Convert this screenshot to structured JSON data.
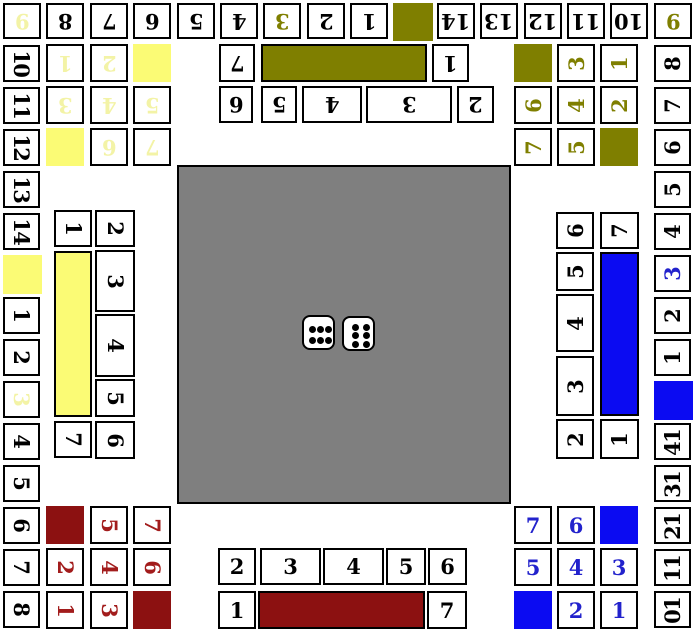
{
  "board": {
    "width": 694,
    "height": 630,
    "background": "#ffffff"
  },
  "palette": {
    "border": "#000000",
    "cell_bg": "#ffffff",
    "black": "#000000",
    "gray_center": "#7f7f7f",
    "olive": "#7f7f00",
    "yellow_fill": "#fbfb75",
    "yellow_text": "#f3f3a6",
    "blue_fill": "#0b0bf2",
    "blue_text": "#2222cc",
    "red_fill": "#8c1111",
    "red_text": "#a21c1c"
  },
  "center": {
    "x": 177,
    "y": 165,
    "w": 334,
    "h": 339
  },
  "dice": {
    "values": [
      6,
      6
    ],
    "items": [
      {
        "name": "die-left",
        "x": 302,
        "y": 315,
        "w": 33,
        "h": 35,
        "pips": "6h"
      },
      {
        "name": "die-right",
        "x": 342,
        "y": 316,
        "w": 33,
        "h": 35,
        "pips": "6v"
      }
    ]
  },
  "regions": [
    {
      "name": "track-top",
      "rot": 180,
      "text": "black",
      "fill": "olive",
      "cells": [
        {
          "l": "9",
          "x": 3,
          "y": 3,
          "w": 38,
          "h": 36,
          "tc": "yellow_text"
        },
        {
          "l": "8",
          "x": 46,
          "y": 3,
          "w": 38,
          "h": 36
        },
        {
          "l": "7",
          "x": 90,
          "y": 3,
          "w": 38,
          "h": 36
        },
        {
          "l": "6",
          "x": 133,
          "y": 3,
          "w": 38,
          "h": 36
        },
        {
          "l": "5",
          "x": 177,
          "y": 3,
          "w": 38,
          "h": 36
        },
        {
          "l": "4",
          "x": 220,
          "y": 3,
          "w": 38,
          "h": 36
        },
        {
          "l": "3",
          "x": 263,
          "y": 3,
          "w": 38,
          "h": 36,
          "tc": "olive"
        },
        {
          "l": "2",
          "x": 307,
          "y": 3,
          "w": 38,
          "h": 36
        },
        {
          "l": "1",
          "x": 350,
          "y": 3,
          "w": 38,
          "h": 36
        },
        {
          "l": null,
          "x": 393,
          "y": 3,
          "w": 40,
          "h": 38
        },
        {
          "l": "14",
          "x": 437,
          "y": 3,
          "w": 38,
          "h": 36
        },
        {
          "l": "13",
          "x": 480,
          "y": 3,
          "w": 38,
          "h": 36
        },
        {
          "l": "12",
          "x": 524,
          "y": 3,
          "w": 38,
          "h": 36
        },
        {
          "l": "11",
          "x": 567,
          "y": 3,
          "w": 38,
          "h": 36
        },
        {
          "l": "10",
          "x": 610,
          "y": 3,
          "w": 38,
          "h": 36
        },
        {
          "l": "9",
          "x": 654,
          "y": 3,
          "w": 38,
          "h": 36,
          "tc": "olive"
        }
      ]
    },
    {
      "name": "track-left",
      "rot": 90,
      "text": "black",
      "fill": "yellow_fill",
      "cells": [
        {
          "l": "10",
          "x": 3,
          "y": 45,
          "w": 37,
          "h": 37
        },
        {
          "l": "11",
          "x": 3,
          "y": 87,
          "w": 37,
          "h": 37
        },
        {
          "l": "12",
          "x": 3,
          "y": 129,
          "w": 37,
          "h": 37
        },
        {
          "l": "13",
          "x": 3,
          "y": 171,
          "w": 37,
          "h": 37
        },
        {
          "l": "14",
          "x": 3,
          "y": 213,
          "w": 37,
          "h": 37
        },
        {
          "l": null,
          "x": 3,
          "y": 255,
          "w": 39,
          "h": 39
        },
        {
          "l": "1",
          "x": 3,
          "y": 297,
          "w": 37,
          "h": 37
        },
        {
          "l": "2",
          "x": 3,
          "y": 339,
          "w": 37,
          "h": 37
        },
        {
          "l": "3",
          "x": 3,
          "y": 381,
          "w": 37,
          "h": 37,
          "tc": "yellow_text"
        },
        {
          "l": "4",
          "x": 3,
          "y": 423,
          "w": 37,
          "h": 37
        },
        {
          "l": "5",
          "x": 3,
          "y": 465,
          "w": 37,
          "h": 37
        },
        {
          "l": "6",
          "x": 3,
          "y": 507,
          "w": 37,
          "h": 37
        },
        {
          "l": "7",
          "x": 3,
          "y": 549,
          "w": 37,
          "h": 37
        },
        {
          "l": "8",
          "x": 3,
          "y": 591,
          "w": 37,
          "h": 37
        }
      ]
    },
    {
      "name": "track-right",
      "rot": -90,
      "text": "black",
      "fill": "blue_fill",
      "cells": [
        {
          "l": "8",
          "x": 654,
          "y": 45,
          "w": 37,
          "h": 37
        },
        {
          "l": "7",
          "x": 654,
          "y": 87,
          "w": 37,
          "h": 37
        },
        {
          "l": "6",
          "x": 654,
          "y": 129,
          "w": 37,
          "h": 37
        },
        {
          "l": "5",
          "x": 654,
          "y": 171,
          "w": 37,
          "h": 37
        },
        {
          "l": "4",
          "x": 654,
          "y": 213,
          "w": 37,
          "h": 37
        },
        {
          "l": "3",
          "x": 654,
          "y": 255,
          "w": 37,
          "h": 37,
          "tc": "blue_text"
        },
        {
          "l": "2",
          "x": 654,
          "y": 297,
          "w": 37,
          "h": 37
        },
        {
          "l": "1",
          "x": 654,
          "y": 339,
          "w": 37,
          "h": 37
        },
        {
          "l": null,
          "x": 654,
          "y": 381,
          "w": 39,
          "h": 39
        },
        {
          "l": "14",
          "x": 654,
          "y": 423,
          "w": 37,
          "h": 37
        },
        {
          "l": "13",
          "x": 654,
          "y": 465,
          "w": 37,
          "h": 37
        },
        {
          "l": "12",
          "x": 654,
          "y": 507,
          "w": 37,
          "h": 37
        },
        {
          "l": "11",
          "x": 654,
          "y": 549,
          "w": 37,
          "h": 37
        },
        {
          "l": "10",
          "x": 654,
          "y": 591,
          "w": 37,
          "h": 37
        }
      ]
    },
    {
      "name": "stable-yellow",
      "rot": 180,
      "text": "yellow_text",
      "fill": "yellow_fill",
      "cells": [
        {
          "l": "1",
          "x": 46,
          "y": 44,
          "w": 38,
          "h": 38
        },
        {
          "l": "2",
          "x": 90,
          "y": 44,
          "w": 38,
          "h": 38
        },
        {
          "l": null,
          "x": 133,
          "y": 44,
          "w": 38,
          "h": 38
        },
        {
          "l": "3",
          "x": 46,
          "y": 86,
          "w": 38,
          "h": 38
        },
        {
          "l": "4",
          "x": 90,
          "y": 86,
          "w": 38,
          "h": 38
        },
        {
          "l": "5",
          "x": 133,
          "y": 86,
          "w": 38,
          "h": 38
        },
        {
          "l": null,
          "x": 46,
          "y": 128,
          "w": 38,
          "h": 38
        },
        {
          "l": "6",
          "x": 90,
          "y": 128,
          "w": 38,
          "h": 38
        },
        {
          "l": "7",
          "x": 133,
          "y": 128,
          "w": 38,
          "h": 38
        }
      ]
    },
    {
      "name": "stable-olive",
      "rot": -90,
      "text": "olive",
      "fill": "olive",
      "cells": [
        {
          "l": null,
          "x": 514,
          "y": 44,
          "w": 38,
          "h": 38
        },
        {
          "l": "3",
          "x": 557,
          "y": 44,
          "w": 38,
          "h": 38
        },
        {
          "l": "1",
          "x": 600,
          "y": 44,
          "w": 38,
          "h": 38
        },
        {
          "l": "6",
          "x": 514,
          "y": 86,
          "w": 38,
          "h": 38
        },
        {
          "l": "4",
          "x": 557,
          "y": 86,
          "w": 38,
          "h": 38
        },
        {
          "l": "2",
          "x": 600,
          "y": 86,
          "w": 38,
          "h": 38
        },
        {
          "l": "7",
          "x": 514,
          "y": 128,
          "w": 38,
          "h": 38
        },
        {
          "l": "5",
          "x": 557,
          "y": 128,
          "w": 38,
          "h": 38
        },
        {
          "l": null,
          "x": 600,
          "y": 128,
          "w": 38,
          "h": 38
        }
      ]
    },
    {
      "name": "stable-blue",
      "rot": 0,
      "text": "blue_text",
      "fill": "blue_fill",
      "cells": [
        {
          "l": "7",
          "x": 514,
          "y": 506,
          "w": 38,
          "h": 38
        },
        {
          "l": "6",
          "x": 557,
          "y": 506,
          "w": 38,
          "h": 38
        },
        {
          "l": null,
          "x": 600,
          "y": 506,
          "w": 38,
          "h": 38
        },
        {
          "l": "5",
          "x": 514,
          "y": 548,
          "w": 38,
          "h": 38
        },
        {
          "l": "4",
          "x": 557,
          "y": 548,
          "w": 38,
          "h": 38
        },
        {
          "l": "3",
          "x": 600,
          "y": 548,
          "w": 38,
          "h": 38
        },
        {
          "l": null,
          "x": 514,
          "y": 591,
          "w": 38,
          "h": 38
        },
        {
          "l": "2",
          "x": 557,
          "y": 591,
          "w": 38,
          "h": 38
        },
        {
          "l": "1",
          "x": 600,
          "y": 591,
          "w": 38,
          "h": 38
        }
      ]
    },
    {
      "name": "stable-red",
      "rot": 90,
      "text": "red_text",
      "fill": "red_fill",
      "cells": [
        {
          "l": null,
          "x": 46,
          "y": 506,
          "w": 38,
          "h": 38
        },
        {
          "l": "5",
          "x": 90,
          "y": 506,
          "w": 38,
          "h": 38
        },
        {
          "l": "7",
          "x": 133,
          "y": 506,
          "w": 38,
          "h": 38
        },
        {
          "l": "2",
          "x": 46,
          "y": 548,
          "w": 38,
          "h": 38
        },
        {
          "l": "4",
          "x": 90,
          "y": 548,
          "w": 38,
          "h": 38
        },
        {
          "l": "6",
          "x": 133,
          "y": 548,
          "w": 38,
          "h": 38
        },
        {
          "l": "1",
          "x": 46,
          "y": 591,
          "w": 38,
          "h": 38
        },
        {
          "l": "3",
          "x": 90,
          "y": 591,
          "w": 38,
          "h": 38
        },
        {
          "l": null,
          "x": 133,
          "y": 591,
          "w": 38,
          "h": 38
        }
      ]
    },
    {
      "name": "home-olive",
      "rot": 180,
      "text": "black",
      "fill": "olive",
      "cells": [
        {
          "l": "7",
          "x": 219,
          "y": 44,
          "w": 36,
          "h": 38
        },
        {
          "l": "1",
          "x": 432,
          "y": 44,
          "w": 37,
          "h": 38
        },
        {
          "l": "6",
          "x": 219,
          "y": 86,
          "w": 34,
          "h": 37
        },
        {
          "l": "5",
          "x": 261,
          "y": 86,
          "w": 36,
          "h": 37
        },
        {
          "l": "4",
          "x": 302,
          "y": 86,
          "w": 60,
          "h": 37
        },
        {
          "l": "3",
          "x": 366,
          "y": 86,
          "w": 86,
          "h": 37
        },
        {
          "l": "2",
          "x": 457,
          "y": 86,
          "w": 37,
          "h": 37
        }
      ],
      "bar": {
        "x": 261,
        "y": 44,
        "w": 166,
        "h": 38
      }
    },
    {
      "name": "home-red",
      "rot": 0,
      "text": "black",
      "fill": "red_fill",
      "cells": [
        {
          "l": "2",
          "x": 218,
          "y": 548,
          "w": 38,
          "h": 37
        },
        {
          "l": "3",
          "x": 260,
          "y": 548,
          "w": 61,
          "h": 37
        },
        {
          "l": "4",
          "x": 323,
          "y": 548,
          "w": 61,
          "h": 37
        },
        {
          "l": "5",
          "x": 386,
          "y": 548,
          "w": 40,
          "h": 37
        },
        {
          "l": "6",
          "x": 428,
          "y": 548,
          "w": 39,
          "h": 37
        },
        {
          "l": "1",
          "x": 218,
          "y": 591,
          "w": 38,
          "h": 38
        },
        {
          "l": "7",
          "x": 427,
          "y": 591,
          "w": 40,
          "h": 38
        }
      ],
      "bar": {
        "x": 258,
        "y": 591,
        "w": 167,
        "h": 38
      }
    },
    {
      "name": "home-yellow",
      "rot": 90,
      "text": "black",
      "fill": "yellow_fill",
      "cells": [
        {
          "l": "1",
          "x": 54,
          "y": 210,
          "w": 38,
          "h": 37
        },
        {
          "l": "7",
          "x": 54,
          "y": 421,
          "w": 38,
          "h": 37
        },
        {
          "l": "2",
          "x": 95,
          "y": 210,
          "w": 40,
          "h": 37
        },
        {
          "l": "3",
          "x": 95,
          "y": 250,
          "w": 40,
          "h": 62
        },
        {
          "l": "4",
          "x": 95,
          "y": 314,
          "w": 40,
          "h": 63
        },
        {
          "l": "5",
          "x": 95,
          "y": 379,
          "w": 40,
          "h": 38
        },
        {
          "l": "6",
          "x": 95,
          "y": 421,
          "w": 40,
          "h": 38
        }
      ],
      "bar": {
        "x": 54,
        "y": 251,
        "w": 38,
        "h": 166
      }
    },
    {
      "name": "home-blue",
      "rot": -90,
      "text": "black",
      "fill": "blue_fill",
      "cells": [
        {
          "l": "6",
          "x": 556,
          "y": 212,
          "w": 38,
          "h": 37
        },
        {
          "l": "5",
          "x": 556,
          "y": 252,
          "w": 38,
          "h": 39
        },
        {
          "l": "4",
          "x": 556,
          "y": 294,
          "w": 38,
          "h": 58
        },
        {
          "l": "3",
          "x": 556,
          "y": 356,
          "w": 38,
          "h": 60
        },
        {
          "l": "2",
          "x": 556,
          "y": 419,
          "w": 38,
          "h": 40
        },
        {
          "l": "7",
          "x": 600,
          "y": 212,
          "w": 39,
          "h": 37
        },
        {
          "l": "1",
          "x": 600,
          "y": 419,
          "w": 39,
          "h": 40
        }
      ],
      "bar": {
        "x": 600,
        "y": 252,
        "w": 39,
        "h": 164
      }
    }
  ]
}
